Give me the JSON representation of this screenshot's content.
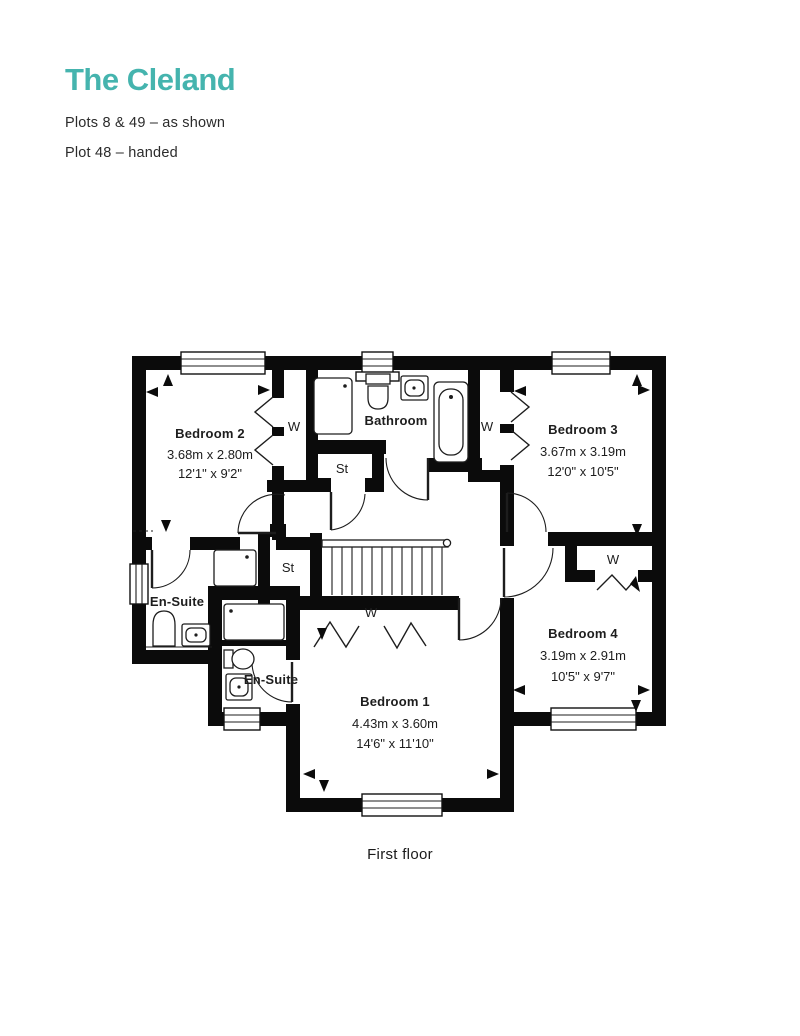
{
  "header": {
    "title": "The Cleland",
    "plots_line": "Plots 8 & 49 – as shown",
    "handed_line": "Plot 48 – handed"
  },
  "floorplan": {
    "caption": "First floor",
    "rooms": {
      "bedroom1": {
        "name": "Bedroom 1",
        "metric": "4.43m x 3.60m",
        "imperial": "14'6\" x 11'10\""
      },
      "bedroom2": {
        "name": "Bedroom 2",
        "metric": "3.68m x 2.80m",
        "imperial": "12'1\" x 9'2\""
      },
      "bedroom3": {
        "name": "Bedroom 3",
        "metric": "3.67m x 3.19m",
        "imperial": "12'0\" x 10'5\""
      },
      "bedroom4": {
        "name": "Bedroom 4",
        "metric": "3.19m x 2.91m",
        "imperial": "10'5\" x 9'7\""
      },
      "bathroom": {
        "name": "Bathroom"
      },
      "ensuite_1": {
        "name": "En-Suite"
      },
      "ensuite_2": {
        "name": "En-Suite"
      }
    },
    "labels": {
      "wardrobe": "W",
      "store": "St"
    }
  },
  "colors": {
    "accent": "#45b4ae",
    "text": "#262626",
    "wall": "#0b0b0b"
  }
}
